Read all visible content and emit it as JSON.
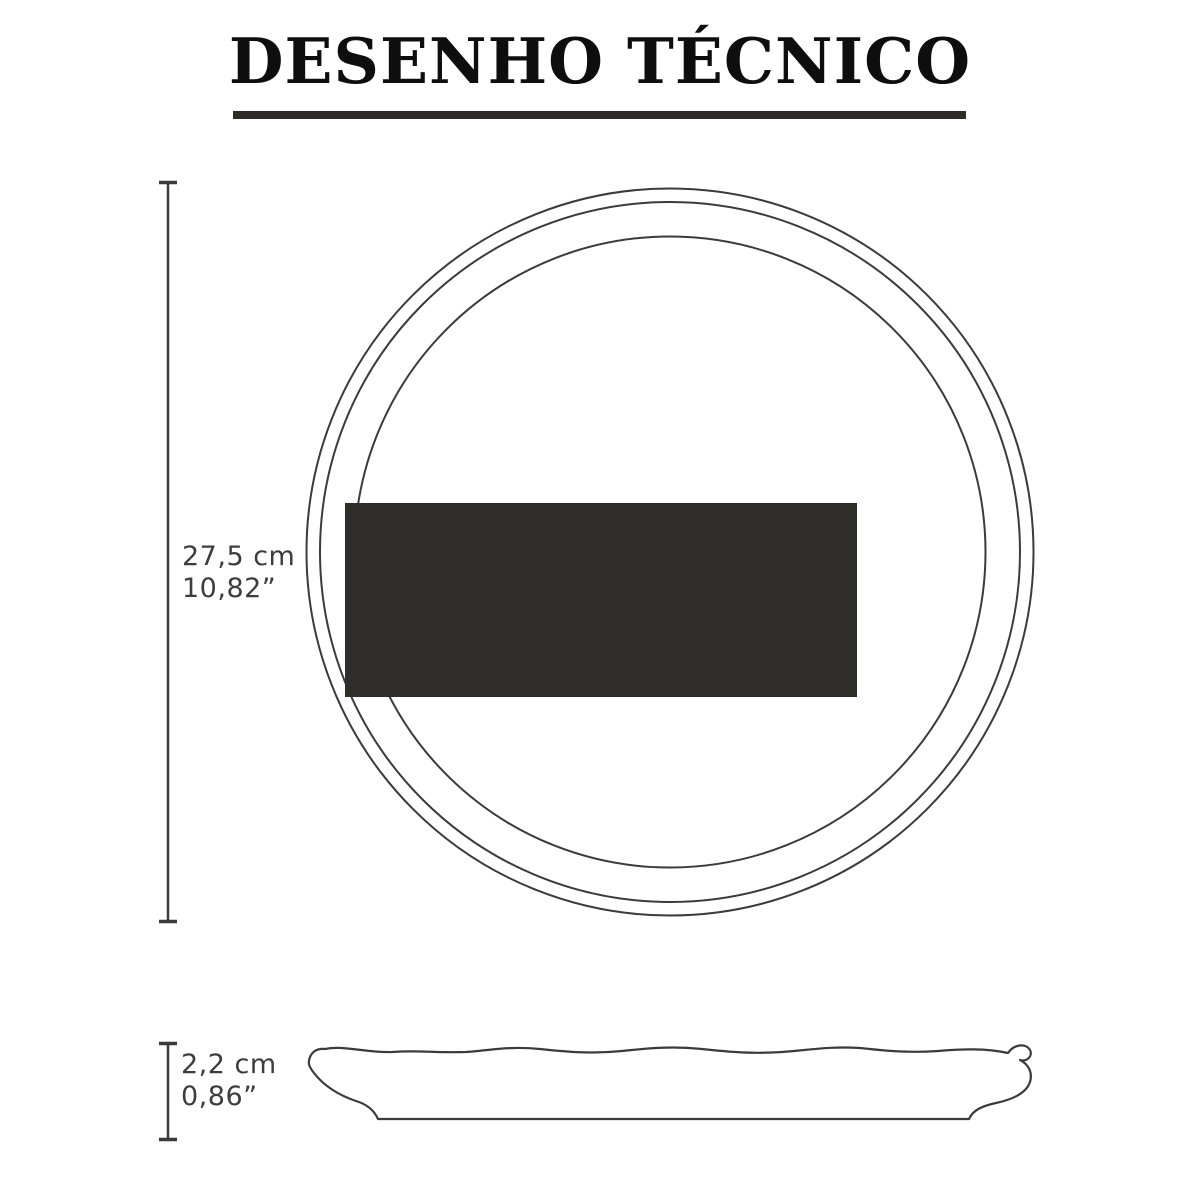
{
  "title": "DESENHO TÉCNICO",
  "top_view": {
    "dimension_cm": "27,5 cm",
    "dimension_in": "10,82”"
  },
  "side_view": {
    "dimension_cm": "2,2 cm",
    "dimension_in": "0,86”"
  },
  "colors": {
    "background": "#ffffff",
    "title-text": "#0e0e0e",
    "underline": "#2e2d29",
    "line": "#3b3b3b",
    "redaction-box": "#2e2d2a",
    "dimension-text": "#3d3d3d"
  }
}
